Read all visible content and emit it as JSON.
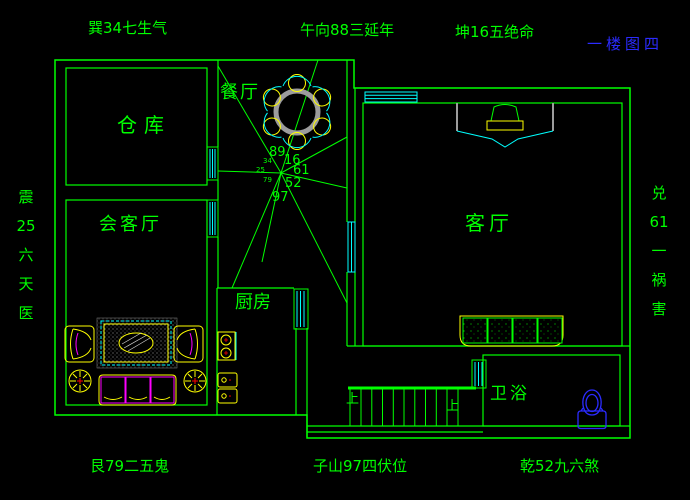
{
  "palette": {
    "wall_green": "#00ff00",
    "window_cyan": "#00ffff",
    "furniture_yellow": "#ffff00",
    "accent_magenta": "#ff00ff",
    "mark_red": "#ff0000",
    "title_blue": "#2b2bff",
    "metal_gray": "#9c9c9c",
    "background": "#000000"
  },
  "border_labels": {
    "top_left": "巽34七生气",
    "top_center": "午向88三延年",
    "top_right": "坤16五绝命",
    "title": "一楼图四",
    "bottom_left": "艮79二五鬼",
    "bottom_center": "子山97四伏位",
    "bottom_right": "乾52九六煞"
  },
  "vertical_left": {
    "chars": [
      "震",
      "25",
      "六",
      "天",
      "医"
    ]
  },
  "vertical_right": {
    "chars": [
      "兑",
      "61",
      "一",
      "祸",
      "害"
    ]
  },
  "rooms": {
    "storeroom": "仓库",
    "reception": "会客厅",
    "dining": "餐厅",
    "living": "客厅",
    "kitchen": "厨房",
    "bathroom": "卫浴"
  },
  "compass": {
    "main": [
      "89",
      "16",
      "61",
      "52",
      "97"
    ],
    "minor": [
      "34",
      "25",
      "79"
    ]
  },
  "stairs": {
    "up_label_left": "上",
    "up_label_right": "上"
  }
}
